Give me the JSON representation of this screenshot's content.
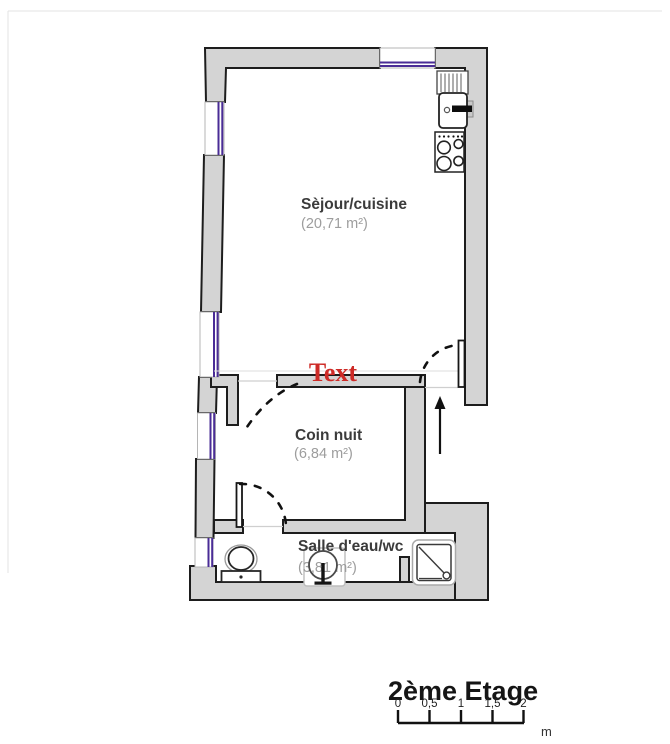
{
  "plan": {
    "annotation": "Text",
    "rooms": [
      {
        "name": "Sèjour/cuisine",
        "area": "(20,71 m²)"
      },
      {
        "name": "Coin nuit",
        "area": "(6,84 m²)"
      },
      {
        "name": "Salle d'eau/wc",
        "area": "(3,81 m²)"
      }
    ],
    "floor": {
      "title": "2ème Etage",
      "scale_ticks": [
        "0",
        "0,5",
        "1",
        "1,5",
        "2"
      ],
      "scale_unit": "m"
    },
    "colors": {
      "wall_fill": "#d4d4d4",
      "wall_stroke": "#1d1d1d",
      "window_glass": "#4a2c96",
      "annotation_red": "#ce2b27",
      "room_label": "#3b3b3b",
      "room_area": "#9d9d9d"
    }
  }
}
